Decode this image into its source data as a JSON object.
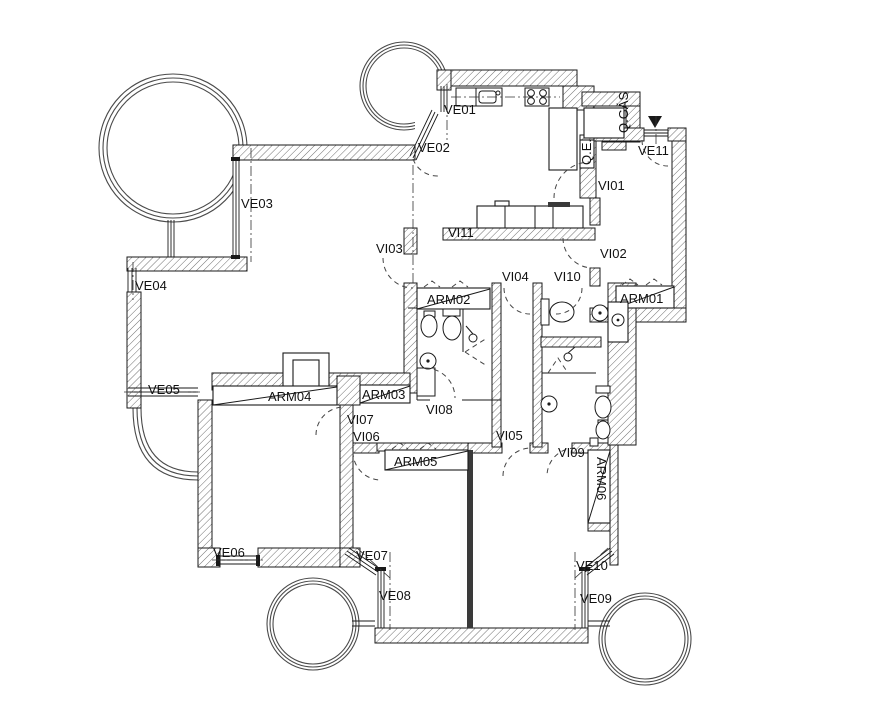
{
  "drawing": {
    "type": "architectural floor plan",
    "background": "#ffffff",
    "line_color": "#1a1a1a",
    "hatch_color": "#707070"
  },
  "labels": {
    "ve01": "VE01",
    "ve02": "VE02",
    "ve03": "VE03",
    "ve04": "VE04",
    "ve05": "VE05",
    "ve06": "VE06",
    "ve07": "VE07",
    "ve08": "VE08",
    "ve09": "VE09",
    "ve10": "VE10",
    "ve11": "VE11",
    "vi01": "VI01",
    "vi02": "VI02",
    "vi03": "VI03",
    "vi04": "VI04",
    "vi05": "VI05",
    "vi06": "VI06",
    "vi07": "VI07",
    "vi08": "VI08",
    "vi09": "VI09",
    "vi10": "VI10",
    "vi11": "VI11",
    "arm01": "ARM01",
    "arm02": "ARM02",
    "arm03": "ARM03",
    "arm04": "ARM04",
    "arm05": "ARM05",
    "arm06": "ARM06",
    "q_gas": "Q.GÁS",
    "q_e": "Q.E."
  }
}
